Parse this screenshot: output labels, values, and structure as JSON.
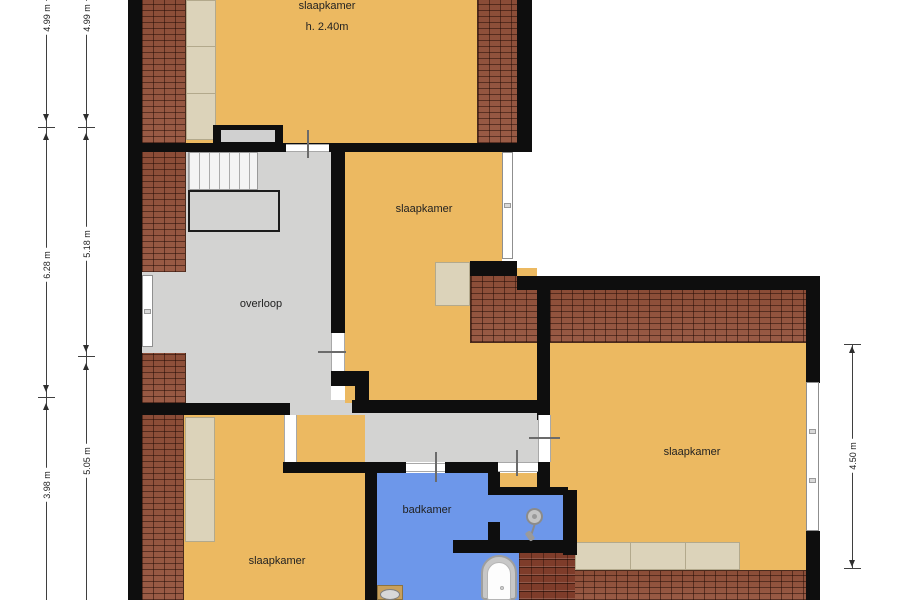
{
  "rooms": {
    "top": {
      "label": "slaapkamer",
      "height_note": "h. 2.40m"
    },
    "middle": {
      "label": "slaapkamer"
    },
    "landing": {
      "label": "overloop"
    },
    "bottom_left": {
      "label": "slaapkamer"
    },
    "bathroom": {
      "label": "badkamer"
    },
    "right": {
      "label": "slaapkamer"
    }
  },
  "dimensions": {
    "left_outer": {
      "top": "4.99 m",
      "middle": "6.28 m",
      "bottom": "3.98 m"
    },
    "left_inner": {
      "top": "4.99 m",
      "middle": "5.18 m",
      "bottom": "5.05 m"
    },
    "right": {
      "value": "4.50 m"
    }
  },
  "colors": {
    "floor_orange": "#ecb961",
    "landing_gray": "#d3d3d2",
    "bathroom_blue": "#6d97ea",
    "brick_red": "#93513a",
    "roof_tile": "#7e3c2a",
    "closet_beige": "#dcd3ba",
    "wall_black": "#0e0e0e"
  }
}
